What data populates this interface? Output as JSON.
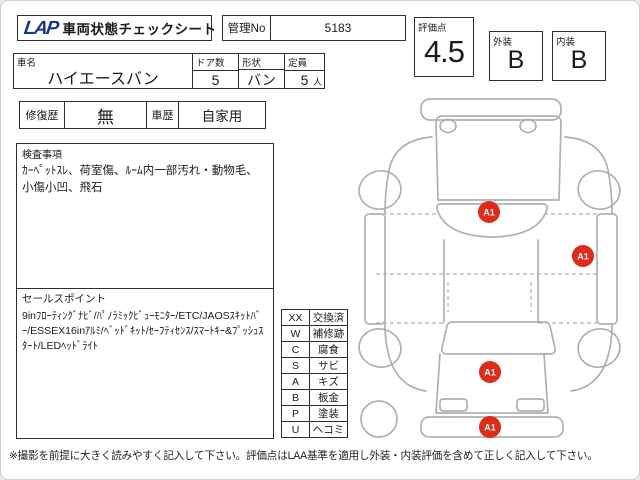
{
  "header": {
    "logo": "LAP",
    "title": "車両状態チェックシート",
    "manage_no_label": "管理No",
    "manage_no_value": "5183",
    "score_label": "評価点",
    "score_value": "4.5",
    "exterior_label": "外装",
    "exterior_grade": "B",
    "interior_label": "内装",
    "interior_grade": "B"
  },
  "vehicle": {
    "name_label": "車名",
    "name_value": "ハイエースバン",
    "doors_label": "ドア数",
    "doors_value": "5",
    "shape_label": "形状",
    "shape_value": "バン",
    "capacity_label": "定員",
    "capacity_value": "5",
    "capacity_unit": "人"
  },
  "history": {
    "repair_label": "修復歴",
    "repair_value": "無",
    "car_history_label": "車歴",
    "car_history_value": "自家用"
  },
  "inspection": {
    "label": "検査事項",
    "text": "ｶｰﾍﾟｯﾄｽﾚ、荷室傷、ﾙｰﾑ内一部汚れ・動物毛、小傷小凹、飛石"
  },
  "sales": {
    "label": "セールスポイント",
    "text": "9inﾌﾛｰﾃｨﾝｸﾞﾅﾋﾞ/ﾊﾟﾉﾗﾐｯｸﾋﾞｭｰﾓﾆﾀｰ/ETC/JAOSｽｷｯﾄﾊﾞｰ/ESSEX16inｱﾙﾐ/ﾍﾞｯﾄﾞｷｯﾄ/ｾｰﾌﾃｨｾﾝｽ/ｽﾏｰﾄｷｰ&ﾌﾟｯｼｭｽﾀｰﾄ/LEDﾍｯﾄﾞﾗｲﾄ"
  },
  "legend": {
    "rows": [
      {
        "code": "XX",
        "label": "交換済"
      },
      {
        "code": "W",
        "label": "補修跡"
      },
      {
        "code": "C",
        "label": "腐食"
      },
      {
        "code": "S",
        "label": "サビ"
      },
      {
        "code": "A",
        "label": "キズ"
      },
      {
        "code": "B",
        "label": "板金"
      },
      {
        "code": "P",
        "label": "塗装"
      },
      {
        "code": "U",
        "label": "ヘコミ"
      }
    ]
  },
  "diagram": {
    "outline_color": "#b0b0b0",
    "marker_color": "#df2b1a",
    "markers": [
      {
        "label": "A1",
        "x": 133,
        "y": 126,
        "location": "windshield"
      },
      {
        "label": "A1",
        "x": 227,
        "y": 170,
        "location": "right-side-panel"
      },
      {
        "label": "A1",
        "x": 134,
        "y": 286,
        "location": "rear-door"
      },
      {
        "label": "A1",
        "x": 134,
        "y": 341,
        "location": "rear-bumper"
      }
    ]
  },
  "footer": {
    "note": "※撮影を前提に大きく読みやすく記入して下さい。評価点はLAA基準を適用し外装・内装評価を含めて正しく記入して下さい。"
  }
}
